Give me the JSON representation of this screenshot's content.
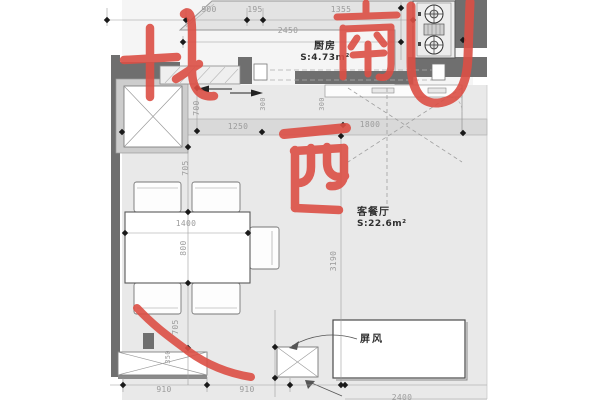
{
  "document": {
    "type": "residential floor plan with handwritten compass marks"
  },
  "rooms": {
    "kitchen": {
      "name": "厨房",
      "area": "S:4.73m²"
    },
    "living_dining": {
      "name": "客餐厅",
      "area": "S:22.6m²"
    }
  },
  "callouts": {
    "screen": "屏风"
  },
  "annotations": {
    "north": "北",
    "south": "南",
    "west": "西",
    "ink_color": "#dc4f45"
  },
  "dims": {
    "a900": "900",
    "a195": "195",
    "a1355": "1355",
    "a2450": "2450",
    "v700": "700",
    "v300a": "300",
    "v300b": "300",
    "b1250": "1250",
    "b1800": "1800",
    "v705a": "705",
    "t1400": "1400",
    "t800": "800",
    "v705b": "705",
    "v350": "350",
    "v3190": "3190",
    "c910a": "910",
    "c910b": "910",
    "c2400": "2400"
  }
}
